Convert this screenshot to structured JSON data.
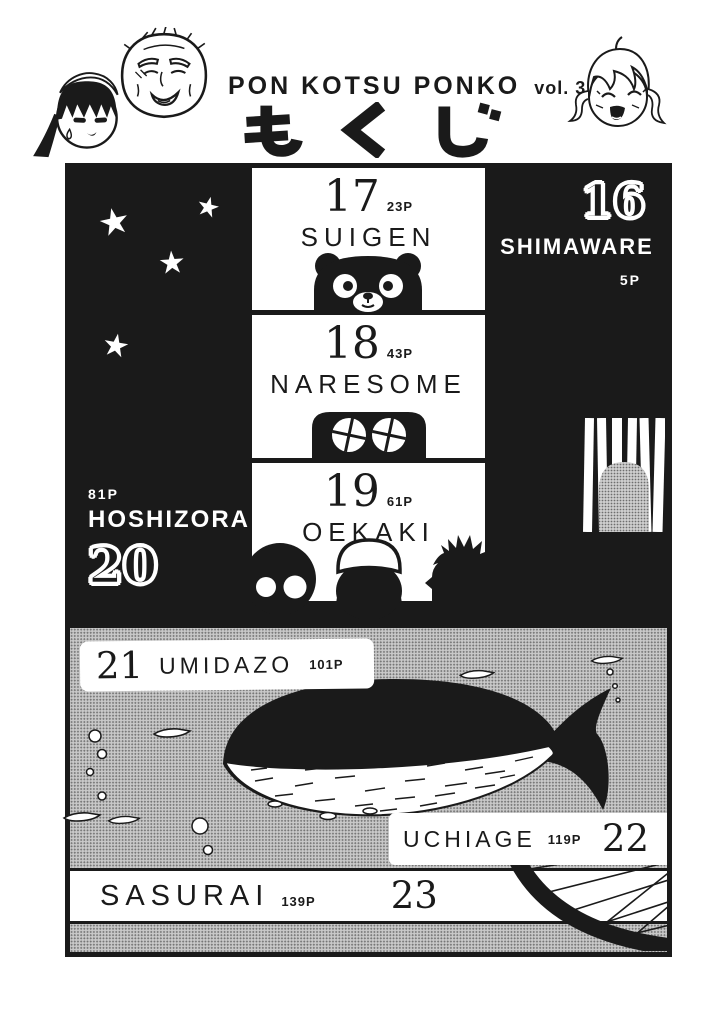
{
  "header": {
    "title": "PON KOTSU PONKO",
    "volume": "vol. 3",
    "kana": "もくじ",
    "kana_meaning": "contents"
  },
  "toc": {
    "chapters": [
      {
        "num": "16",
        "title": "SHIMAWARE",
        "pages": "5P"
      },
      {
        "num": "17",
        "title": "SUIGEN",
        "pages": "23P"
      },
      {
        "num": "18",
        "title": "NARESOME",
        "pages": "43P"
      },
      {
        "num": "19",
        "title": "OEKAKI",
        "pages": "61P"
      },
      {
        "num": "20",
        "title": "HOSHIZORA",
        "pages": "81P"
      },
      {
        "num": "21",
        "title": "UMIDAZO",
        "pages": "101P"
      },
      {
        "num": "22",
        "title": "UCHIAGE",
        "pages": "119P"
      },
      {
        "num": "23",
        "title": "SASURAI",
        "pages": "139P"
      }
    ]
  },
  "colors": {
    "ink": "#1a1a1a",
    "paper": "#ffffff",
    "halftone_gray": "#b9b9b9"
  }
}
